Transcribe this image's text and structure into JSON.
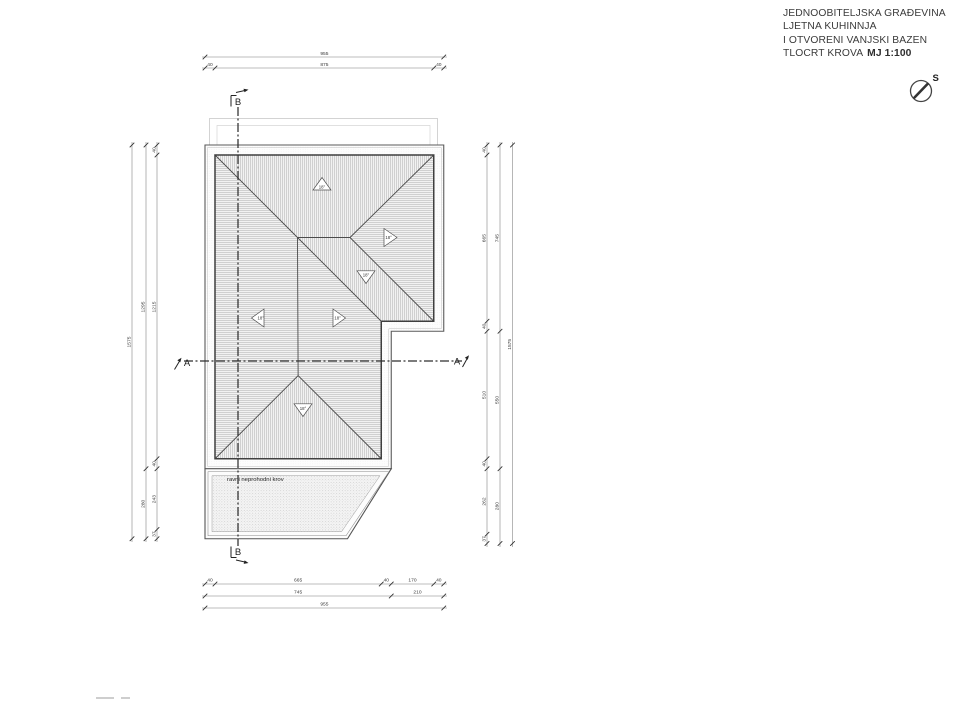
{
  "title_block": {
    "line1": "JEDNOOBITELJSKA GRAĐEVINA",
    "line2": "LJETNA KUHINNJA",
    "line3": "I OTVORENI VANJSKI BAZEN",
    "line4": "TLOCRT KROVA",
    "scale": "MJ 1:100"
  },
  "north": {
    "label": "S"
  },
  "plan": {
    "flat_roof_label": "ravni neprohodni krov",
    "slopes": {
      "north": "18°",
      "east": "18°",
      "southeast": "18°",
      "west": "18°",
      "lower_east": "18°",
      "south": "18°"
    }
  },
  "sections": {
    "a_left": "A",
    "a_right": "A",
    "b_top": "B",
    "b_bottom": "B"
  },
  "dims": {
    "top": {
      "row1": [
        "955"
      ],
      "row2": [
        "40",
        "875",
        "40"
      ]
    },
    "bottom": {
      "row1": [
        "40",
        "665",
        "40",
        "170",
        "40"
      ],
      "row2": [
        "745",
        "210"
      ],
      "row3": [
        "955"
      ]
    },
    "left": {
      "outer": "1575",
      "middle": [
        "1295",
        "280"
      ],
      "inner": [
        "40",
        "1215",
        "40",
        "243",
        "37"
      ]
    },
    "right": {
      "inner": [
        "40",
        "665",
        "40",
        "510",
        "40",
        "262",
        "37"
      ],
      "middle": [
        "745",
        "550",
        "280"
      ],
      "outer": "1575"
    }
  },
  "colors": {
    "line": "#3d3d3d",
    "hatch": "#a8a8a8",
    "dim": "#3a3a3a",
    "paper": "#ffffff"
  }
}
